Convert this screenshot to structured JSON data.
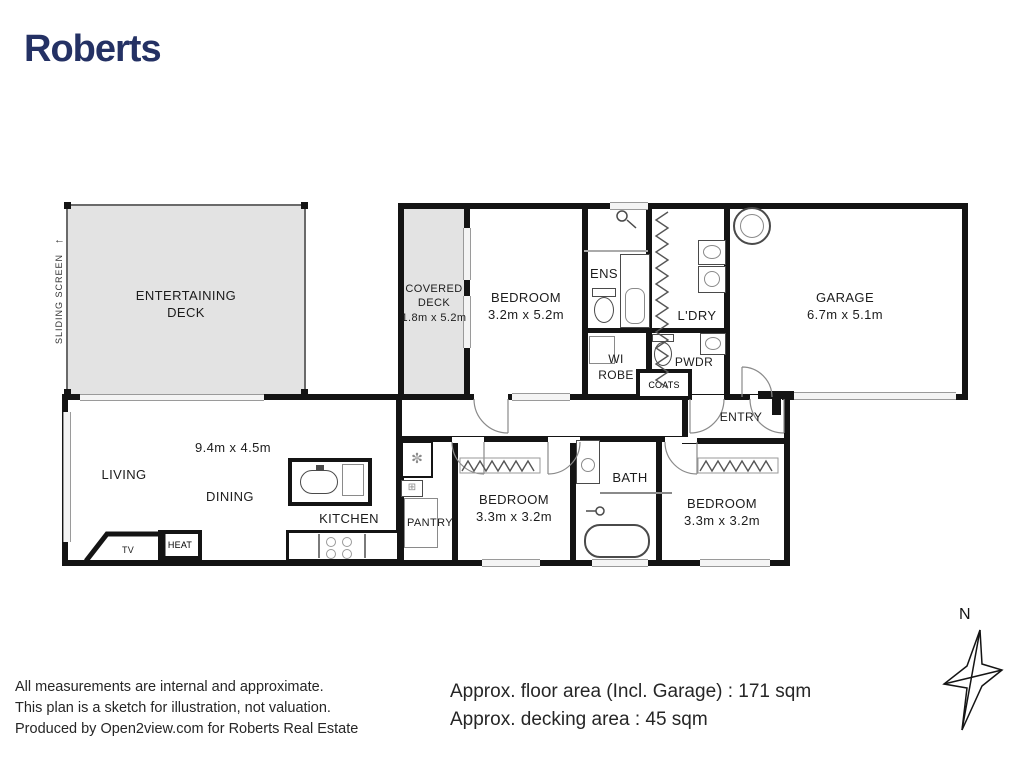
{
  "brand": {
    "name": "Roberts"
  },
  "colors": {
    "brand_navy": "#243164",
    "wall_black": "#141414",
    "deck_gray": "#e3e3e3"
  },
  "plan": {
    "sliding_screen": {
      "label": "SLIDING SCREEN",
      "arrow": "←"
    },
    "rooms": {
      "entertaining_deck": {
        "line1": "ENTERTAINING",
        "line2": "DECK"
      },
      "covered_deck": {
        "line1": "COVERED",
        "line2": "DECK",
        "dims": "1.8m x 5.2m"
      },
      "bedroom_master": {
        "name": "BEDROOM",
        "dims": "3.2m x 5.2m"
      },
      "ens": {
        "name": "ENS"
      },
      "wi_robe": {
        "line1": "WI",
        "line2": "ROBE"
      },
      "ldry": {
        "name": "L'DRY"
      },
      "pwdr": {
        "name": "PWDR"
      },
      "coats": {
        "name": "COATS"
      },
      "garage": {
        "name": "GARAGE",
        "dims": "6.7m x 5.1m"
      },
      "entry": {
        "name": "ENTRY"
      },
      "living_area_dims": "9.4m x 4.5m",
      "living": {
        "name": "LIVING"
      },
      "dining": {
        "name": "DINING"
      },
      "kitchen": {
        "name": "KITCHEN"
      },
      "pantry": {
        "name": "PANTRY"
      },
      "bedroom2": {
        "name": "BEDROOM",
        "dims": "3.3m x 3.2m"
      },
      "bath": {
        "name": "BATH"
      },
      "bedroom3": {
        "name": "BEDROOM",
        "dims": "3.3m x 3.2m"
      },
      "tv": {
        "name": "TV"
      },
      "heat": {
        "name": "HEAT"
      }
    },
    "compass": {
      "north": "N"
    }
  },
  "icons": {
    "fridge_glyph": "✼",
    "appliance_glyph": "⊞"
  },
  "footer": {
    "disclaimer": [
      "All measurements are internal and approximate.",
      "This plan is a sketch for illustration, not valuation.",
      "Produced by Open2view.com for Roberts Real Estate"
    ],
    "areas": {
      "floor_line": "Approx. floor area (Incl. Garage) : 171 sqm",
      "decking_line": "Approx. decking area : 45 sqm"
    }
  }
}
